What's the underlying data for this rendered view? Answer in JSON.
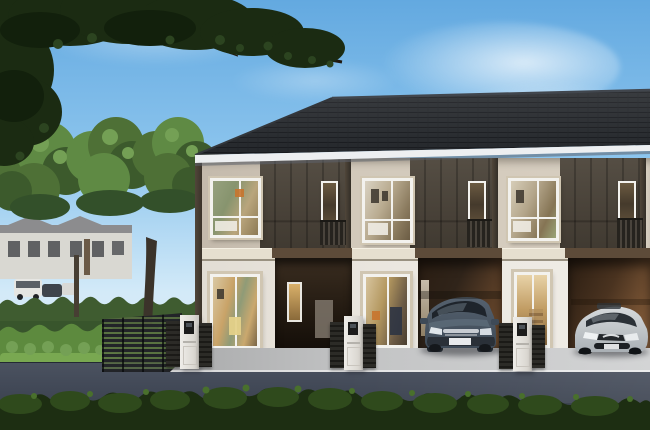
{
  "scene": {
    "title": "3D exterior rendering of a modern two-storey townhouse row with carports, garden hedges and parked cars",
    "setting": "daytime, clear blue sky with light clouds",
    "building": {
      "storeys": 2,
      "units_visible": 4,
      "roof": "dark charcoal tiled hip roof",
      "facade": "cream walls with dark brown vertical panel sections",
      "ground_floor": [
        "sliding glass window",
        "recessed entry porch",
        "glass door",
        "carport with SUV",
        "glass door",
        "carport with sedan"
      ],
      "upper_floor": [
        "large bedroom windows",
        "narrow balcony windows with dark railings"
      ]
    },
    "vehicles": [
      {
        "kind": "suv",
        "color_name": "dark slate gray"
      },
      {
        "kind": "sedan",
        "color_name": "silver"
      }
    ],
    "street_furniture": [
      "white intercom gate pillars",
      "dark slatted gates",
      "horizontal-slat metal fence"
    ],
    "vegetation": [
      "overhanging dark branch top-left",
      "background tree canopies",
      "double hedge rows",
      "foreground dark hedge"
    ],
    "background": "distant white two-storey houses with parked cars"
  },
  "palette": {
    "sky_top": "#63a9e0",
    "sky_mid": "#8ec6ee",
    "sky_horizon": "#d3eaf8",
    "roof_base": "#24272b",
    "roof_line": "#17191d",
    "roof_ridge": "#41464d",
    "fascia": "#edeff1",
    "wall_cream": "#d2c9bb",
    "wall_cream_dark": "#c3b9ab",
    "panel_brown": "#554e44",
    "panel_brown_dark": "#463f36",
    "panel_seam": "#332e27",
    "trim": "#e6dfcf",
    "wall_white": "#ebe7e0",
    "porch_dark": "#241b12",
    "carport_warm": "#6e4c2e",
    "carport_dark": "#2a1d12",
    "win_frame": "#f3f2ee",
    "win_outer": "#d0c6b2",
    "glass_warm": "#c9a368",
    "glass_green": "#87946e",
    "glass_dark": "#453a2c",
    "railing": "#26231e",
    "hedge_dark": "#3f5c30",
    "hedge_bright": "#5d8a3e",
    "lawn": "#79a851",
    "canopy_1": "#4e7036",
    "canopy_2": "#5f8a44",
    "canopy_3": "#3c5a2c",
    "canopy_hl": "#74a055",
    "dark_canopy": "#1b2b12",
    "dark_canopy_2": "#2c4420",
    "trunk": "#3b332a",
    "house_wall": "#d9d8d2",
    "house_roof": "#8c8c8e",
    "fence": "#222428",
    "road": "#424957",
    "pavement": "#c3c4c5",
    "suv_body": "#3e4a57",
    "suv_dark": "#20262d",
    "sedan_body": "#d6dadc",
    "sedan_dark": "#2b3137",
    "pillar": "#efede9",
    "gate": "#2c2b27",
    "intercom": "#1c1c1c",
    "bush_dark": "#1d2e12",
    "bush_mid": "#2f4a1c",
    "bush_hl": "#49702c"
  }
}
